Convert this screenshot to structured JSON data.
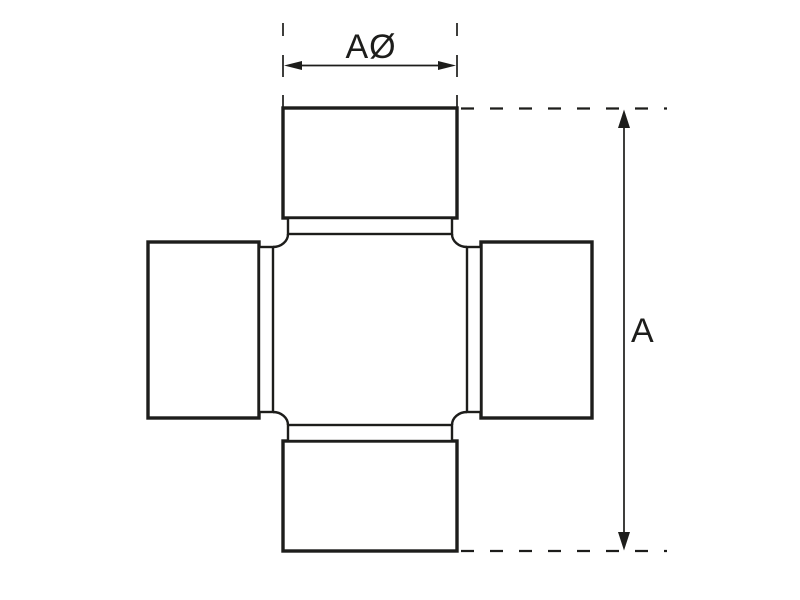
{
  "diagram": {
    "dimension_labels": {
      "cap_diameter": "AØ",
      "overall_length": "A"
    },
    "colors": {
      "line": "#1d1d1b",
      "background": "#ffffff"
    }
  }
}
